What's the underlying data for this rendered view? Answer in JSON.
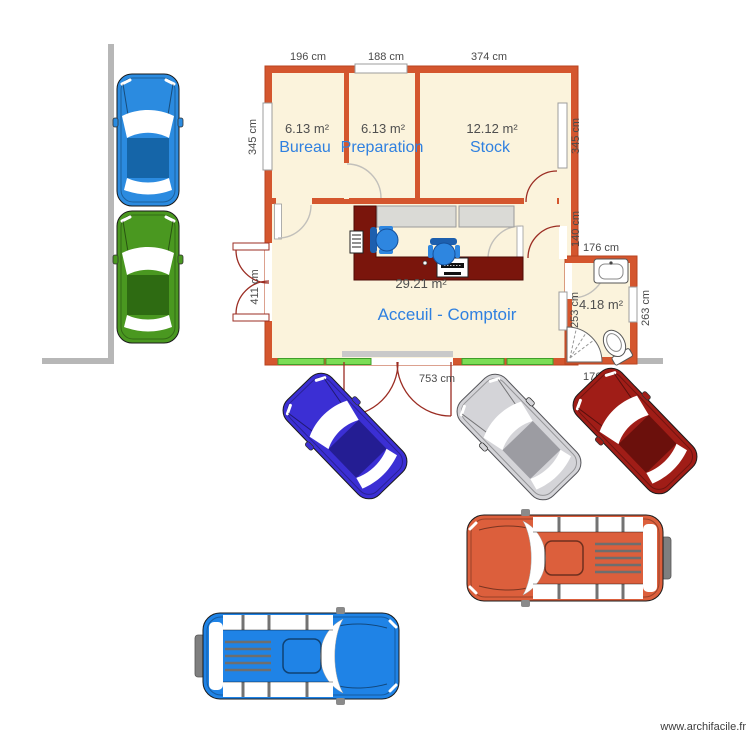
{
  "watermark": {
    "text": "www.archifacile.fr"
  },
  "rooms": {
    "bureau": {
      "name": "Bureau",
      "area": "6.13 m²"
    },
    "preparation": {
      "name": "Preparation",
      "area": "6.13 m²"
    },
    "stock": {
      "name": "Stock",
      "area": "12.12 m²"
    },
    "acceuil": {
      "name": "Acceuil - Comptoir",
      "area": "29.21 m²"
    },
    "sanitaire": {
      "area": "4.18 m²"
    }
  },
  "dimensions": {
    "bureau_width": "196 cm",
    "preparation_width": "188 cm",
    "stock_width": "374 cm",
    "left_height": "345 cm",
    "right_height": "345 cm",
    "right_gap": "140 cm",
    "bath_width": "176 cm",
    "bath_height": "263 cm",
    "bath_inner_height": "253 cm",
    "entry_height": "411 cm",
    "bottom_width": "753 cm",
    "bath_bottom_width": "176 cm"
  },
  "colors": {
    "wall_orange": "#d4562e",
    "room_fill": "#fbf3dc",
    "label_blue": "#2f80e0",
    "counter": "#7a150c",
    "counter_edge": "#4e0a05",
    "window_green": "#7bdd55",
    "exterior_gray": "#b7b7b7",
    "desk_gray": "#dadad6",
    "chair_blue": "#2e86e0",
    "chair_back": "#1d5fae"
  },
  "cars": [
    {
      "name": "blue sedan",
      "body": "#2b8be0",
      "roof": "#1565a8"
    },
    {
      "name": "green sedan",
      "body": "#4a9820",
      "roof": "#2e6b12"
    },
    {
      "name": "indigo sedan",
      "body": "#3b2fd4",
      "roof": "#241d93"
    },
    {
      "name": "silver sedan",
      "body": "#d4d4d8",
      "roof": "#9c9ca2"
    },
    {
      "name": "darkred sedan",
      "body": "#a01d17",
      "roof": "#6b100c"
    },
    {
      "name": "orange suv",
      "body": "#dc5f3c",
      "bumper": "#7f7f7f"
    },
    {
      "name": "blue suv",
      "body": "#1f83e6",
      "bumper": "#7f7f7f"
    }
  ]
}
